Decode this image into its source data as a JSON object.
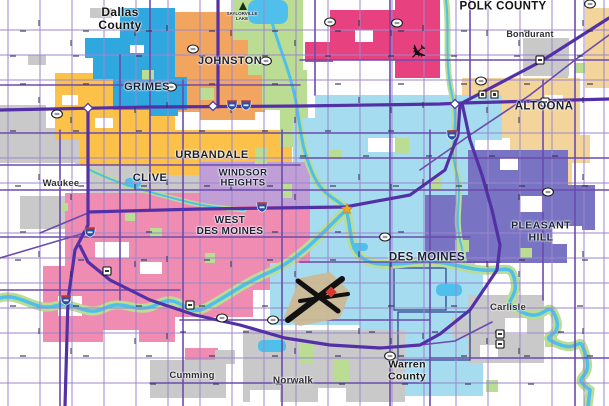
{
  "regions": [
    {
      "id": "grimes",
      "label": "GRIMES",
      "color": "#2FA8DF"
    },
    {
      "id": "johnston",
      "label": "JOHNSTON",
      "color": "#F2A55F"
    },
    {
      "id": "ankeny",
      "label": "",
      "color": "#E8417F"
    },
    {
      "id": "urbandale",
      "label": "URBANDALE",
      "color": "#FBC148"
    },
    {
      "id": "clive",
      "label": "CLIVE",
      "color": "#C9C9C9"
    },
    {
      "id": "waukee",
      "label": "Waukee",
      "color": "#C9C9C9"
    },
    {
      "id": "windsor_heights",
      "label": "WINDSOR\nHEIGHTS",
      "color": "#BF9FD6"
    },
    {
      "id": "west_des_moines",
      "label": "WEST\nDES MOINES",
      "color": "#F08CB2"
    },
    {
      "id": "des_moines",
      "label": "DES MOINES",
      "color": "#A6DCF0"
    },
    {
      "id": "pleasant_hill",
      "label": "PLEASANT HILL",
      "color": "#7873C2"
    },
    {
      "id": "altoona",
      "label": "ALTOONA",
      "color": "#F3D49B"
    },
    {
      "id": "bondurant",
      "label": "Bondurant",
      "color": "#C9C9C9"
    },
    {
      "id": "carlisle",
      "label": "Carlisle",
      "color": "#C9C9C9"
    },
    {
      "id": "norwalk",
      "label": "Norwalk",
      "color": "#C9C9C9"
    },
    {
      "id": "cumming",
      "label": "Cumming",
      "color": "#C9C9C9"
    }
  ],
  "counties": [
    {
      "label": "Dallas\nCounty"
    },
    {
      "label": "POLK COUNTY"
    },
    {
      "label": "Warren\nCounty"
    }
  ],
  "water_labels": [
    {
      "label": "SAYLORVILLE\nLAKE"
    }
  ],
  "icons": {
    "airport_large": "airport-runways-icon",
    "airport_small": "airplane-icon",
    "campground": "campground-triangle-icon",
    "capitol": "capitol-star-icon"
  },
  "colors": {
    "road_minor": "#9C86CC",
    "road_major": "#6C4BAD",
    "highway": "#5430A6",
    "water": "#4FC0EC",
    "park": "#BADC93",
    "white_hole": "#FFFFFF",
    "interstate_blue": "#2B4FA2",
    "interstate_red": "#B33A3A",
    "city_border_navy": "#2B4A8B"
  }
}
